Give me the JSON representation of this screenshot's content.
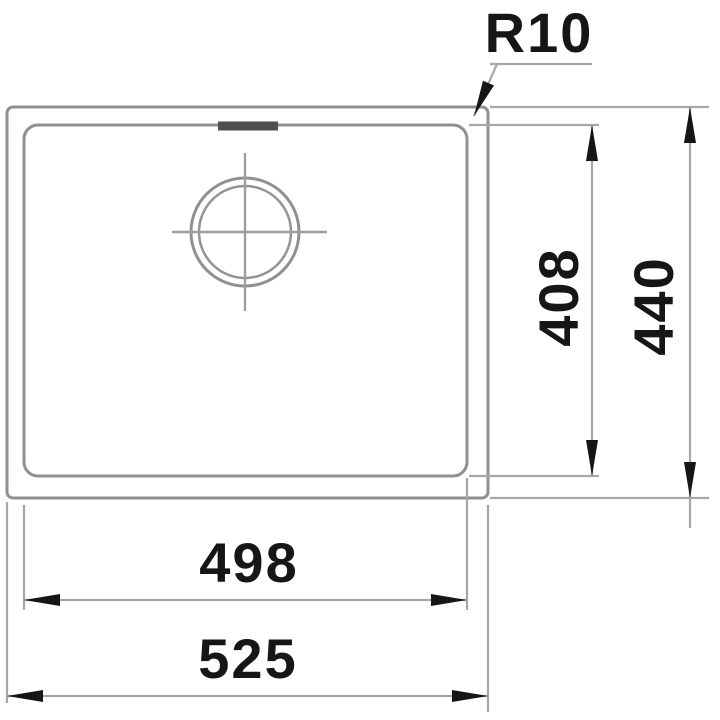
{
  "drawing": {
    "labels": {
      "corner_radius": "R10",
      "bowl_depth": "408",
      "overall_depth": "440",
      "bowl_width": "498",
      "overall_width": "525"
    },
    "colors": {
      "outline": "#909090",
      "dimension_line": "#a8a8a8",
      "arrow": "#161616",
      "text": "#161616",
      "overflow_mark": "#4f4f4f",
      "background": "#ffffff"
    }
  }
}
